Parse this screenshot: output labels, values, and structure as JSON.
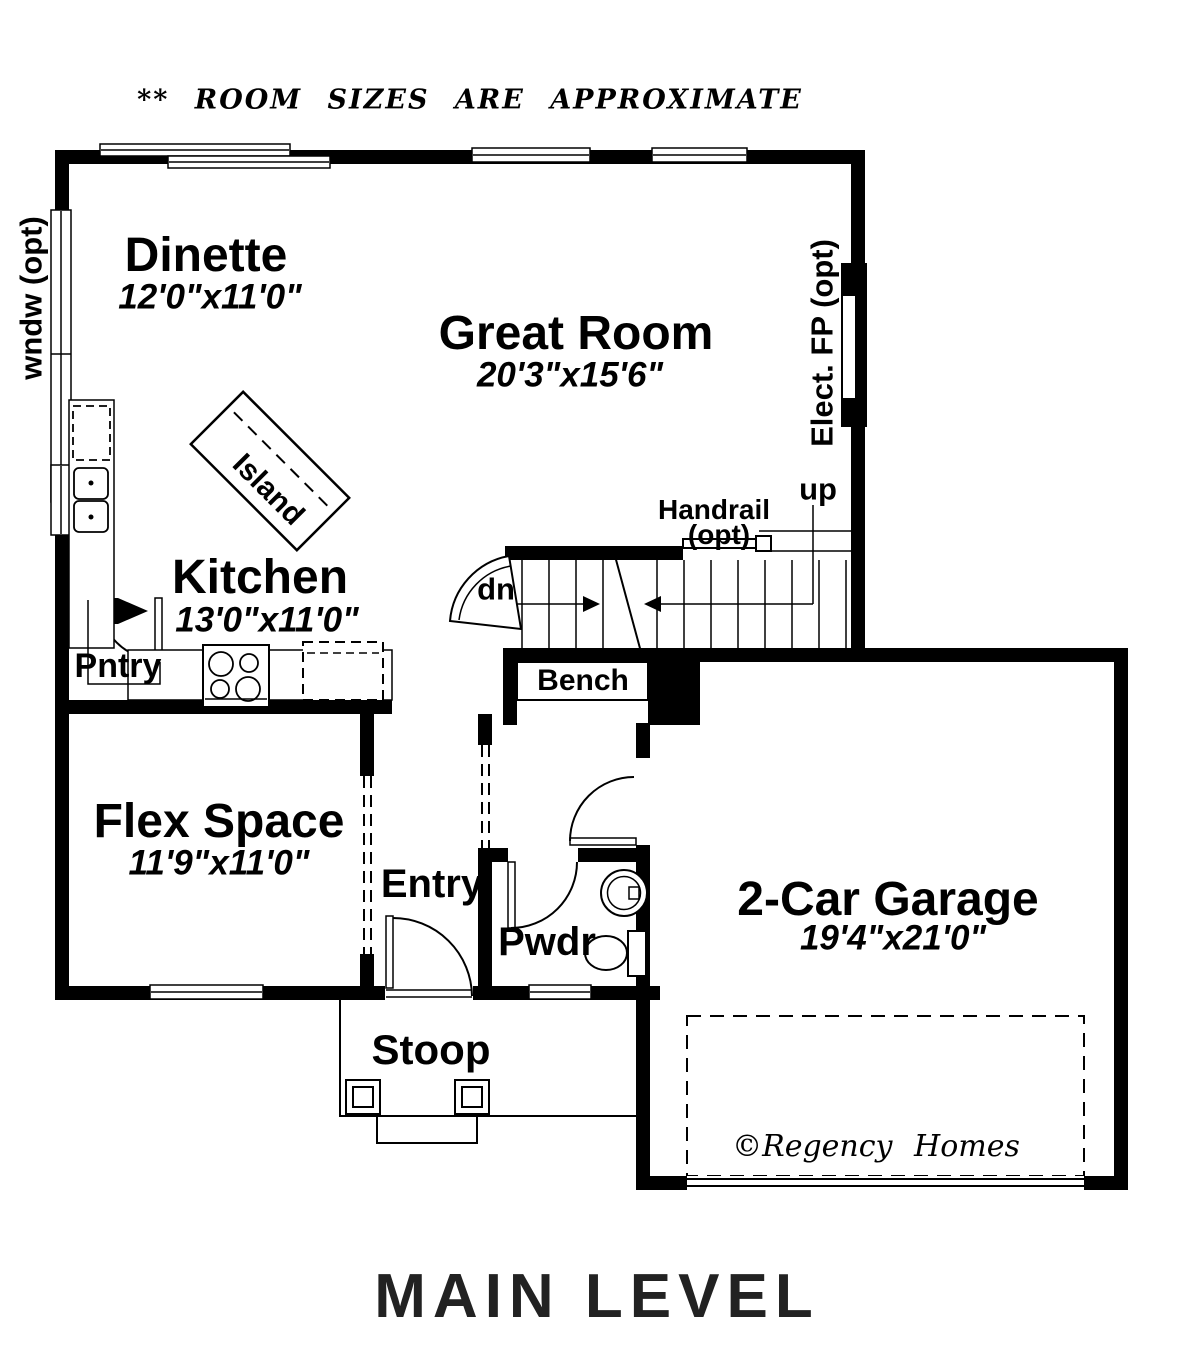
{
  "annotations": {
    "note": "** ROOM SIZES ARE APPROXIMATE",
    "window_opt": "wndw (opt)",
    "fireplace": "Elect. FP (opt)",
    "copyright": "©Regency Homes",
    "title": "MAIN LEVEL"
  },
  "rooms": {
    "dinette": {
      "name": "Dinette",
      "dims": "12'0\"x11'0\""
    },
    "great_room": {
      "name": "Great Room",
      "dims": "20'3\"x15'6\""
    },
    "kitchen": {
      "name": "Kitchen",
      "dims": "13'0\"x11'0\""
    },
    "flex_space": {
      "name": "Flex Space",
      "dims": "11'9\"x11'0\""
    },
    "garage": {
      "name": "2-Car Garage",
      "dims": "19'4\"x21'0\""
    }
  },
  "areas": {
    "island": "Island",
    "pantry": "Pntry",
    "entry": "Entry",
    "powder": "Pwdr",
    "stoop": "Stoop",
    "bench": "Bench"
  },
  "stairs": {
    "handrail": "Handrail",
    "handrail_opt": "(opt)",
    "up": "up",
    "dn": "dn"
  },
  "colors": {
    "wall": "#000000",
    "background": "#ffffff",
    "title_text": "#222222"
  }
}
